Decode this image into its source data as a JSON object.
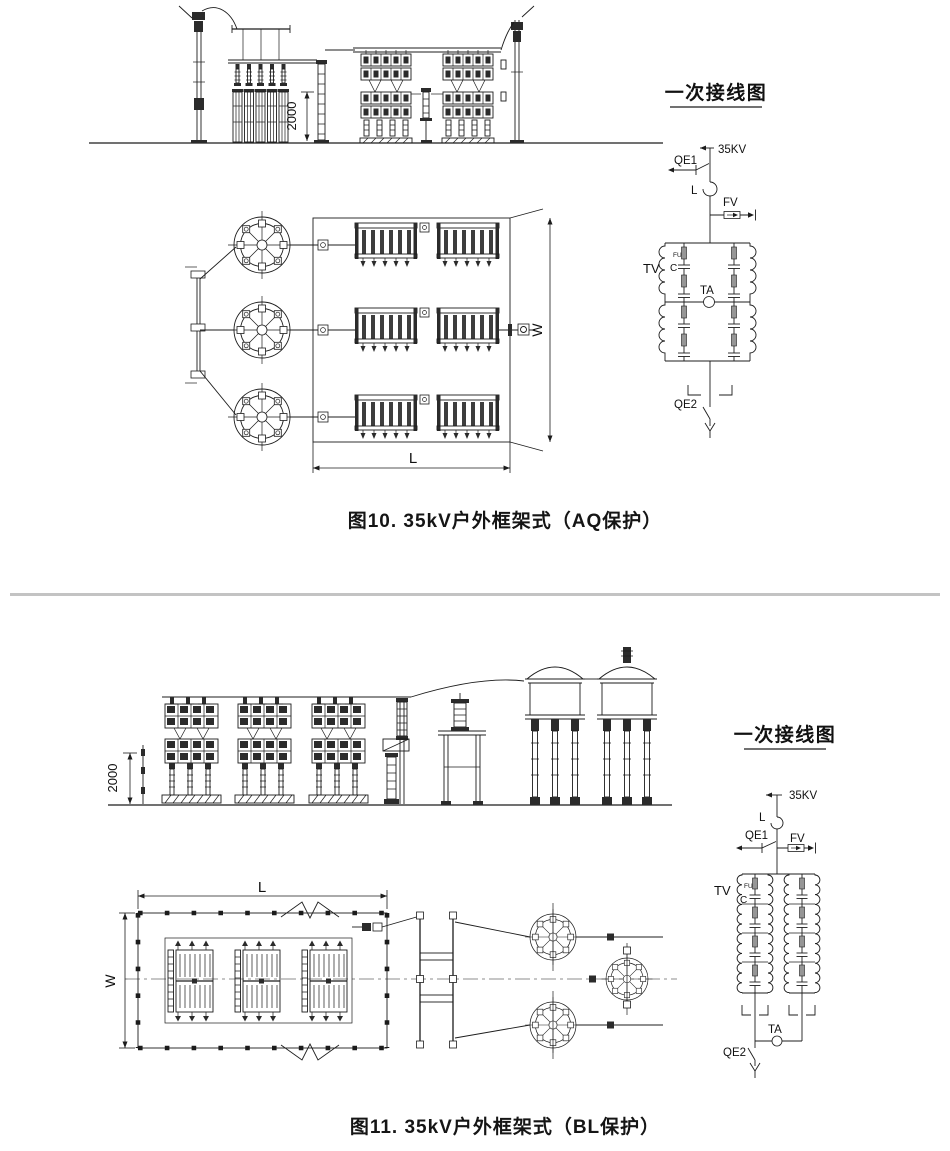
{
  "page": {
    "background": "#ffffff",
    "ink_color": "#1c1c1c",
    "separator_color": "#c3c3c3"
  },
  "figure10": {
    "caption": "图10. 35kV户外框架式（AQ保护）",
    "elevation": {
      "height_dim": "2000"
    },
    "plan": {
      "width_dim": "W",
      "length_dim": "L"
    },
    "schematic": {
      "title": "一次接线图",
      "labels": {
        "voltage": "35KV",
        "qe1": "QE1",
        "reactor": "L",
        "arrester": "FV",
        "vt": "TV",
        "fuse": "FU",
        "capacitor": "C",
        "ct": "TA",
        "qe2": "QE2"
      }
    }
  },
  "figure11": {
    "caption": "图11. 35kV户外框架式（BL保护）",
    "elevation": {
      "height_dim": "2000"
    },
    "plan": {
      "width_dim": "W",
      "length_dim": "L"
    },
    "schematic": {
      "title": "一次接线图",
      "labels": {
        "voltage": "35KV",
        "qe1": "QE1",
        "reactor": "L",
        "arrester": "FV",
        "vt": "TV",
        "fuse": "FU",
        "capacitor": "C",
        "ct": "TA",
        "qe2": "QE2"
      }
    }
  }
}
